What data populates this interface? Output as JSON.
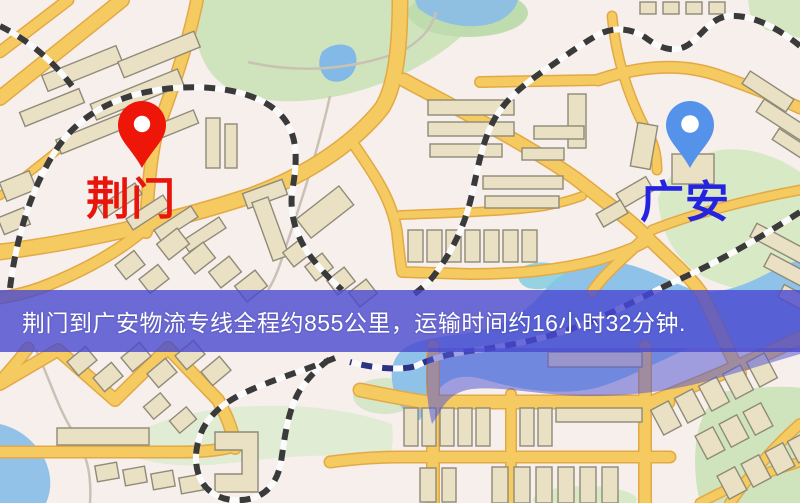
{
  "banner": {
    "text": "荆门到广安物流专线全程约855公里，运输时间约16小时32分钟."
  },
  "markers": [
    {
      "id": "jingmen",
      "label": "荆门",
      "pin_color": "#ee1509",
      "label_color": "#e8150d",
      "icon": "red-pin-icon"
    },
    {
      "id": "guangan",
      "label": "广安",
      "pin_color": "#5593ea",
      "label_color": "#2424e0",
      "icon": "blue-pin-icon"
    }
  ],
  "colors": {
    "banner_bg": "rgba(72,72,208,0.8)",
    "map_background": "#f7efec",
    "road": "#f5ca60",
    "road_casing": "#e2a944",
    "park": "#cfe4bd",
    "water": "#8fc2e8",
    "building": "#eae0c4",
    "railway_dark": "#3a3a3a",
    "railway_navy": "#2c3382",
    "overlay_wash": "rgba(88,90,212,0.55)"
  }
}
